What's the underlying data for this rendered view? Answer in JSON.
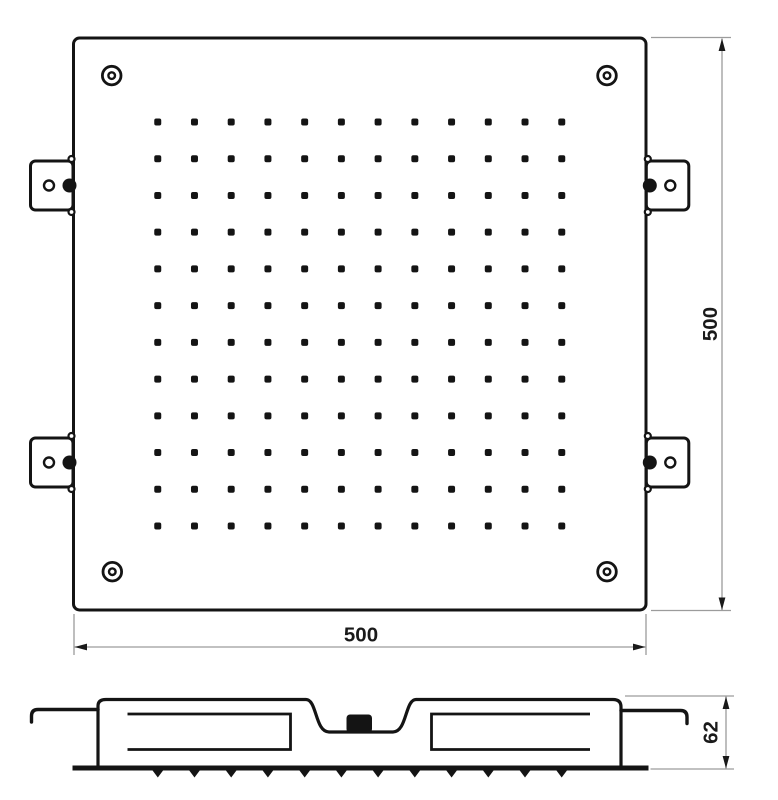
{
  "diagram": {
    "description": "square ceiling shower head technical drawing",
    "top_view": {
      "width_dimension": "500",
      "height_dimension": "500",
      "nozzle_grid": {
        "rows": 12,
        "cols": 12
      },
      "corner_screw_count": 4,
      "bracket_count": 4
    },
    "section_view": {
      "depth_dimension": "62",
      "nozzle_tooth_count": 12
    },
    "colors": {
      "outline": "#141414",
      "dimension_line": "#9c9c9c",
      "label_text": "#1a1a1a",
      "background": "#ffffff"
    }
  }
}
